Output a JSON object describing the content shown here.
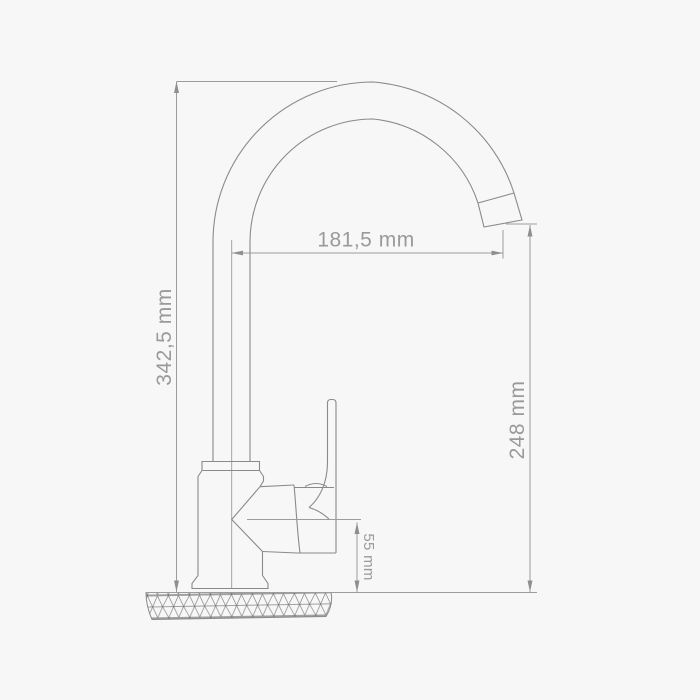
{
  "drawing": {
    "type": "faucet-dimension-drawing",
    "background_color": "#f7f7f7",
    "outline_color": "#8a8a8a",
    "dimension_color": "#9c9c9c",
    "text_color": "#9a9a9a"
  },
  "dimensions": {
    "total_height": {
      "label": "342,5 mm",
      "value": 342.5,
      "unit": "mm",
      "orientation": "vertical-left"
    },
    "spout_reach": {
      "label": "181,5 mm",
      "value": 181.5,
      "unit": "mm",
      "orientation": "horizontal"
    },
    "spout_outlet_height": {
      "label": "248 mm",
      "value": 248,
      "unit": "mm",
      "orientation": "vertical-right"
    },
    "handle_axis_height": {
      "label": "55 mm",
      "value": 55,
      "unit": "mm",
      "orientation": "vertical-small"
    }
  }
}
